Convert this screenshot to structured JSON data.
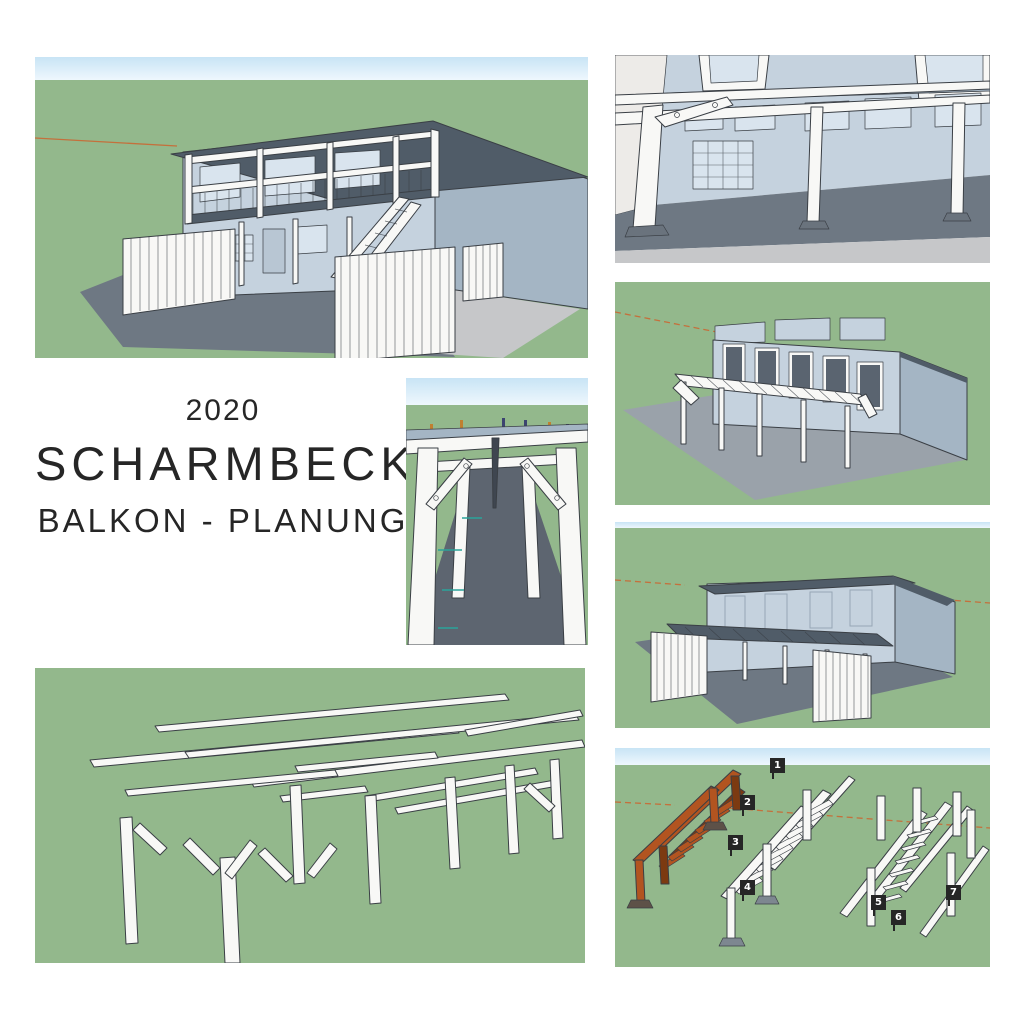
{
  "title": {
    "year": "2020",
    "name": "SCHARMBECK",
    "subtitle": "BALKON - PLANUNG"
  },
  "stair_tags": [
    "1",
    "2",
    "3",
    "4",
    "5",
    "6",
    "7"
  ],
  "colors": {
    "grass": "#93b88c",
    "sky_top": "#c8e4f5",
    "sky_bottom": "#eef7fd",
    "wall_light": "#c5d2de",
    "wall_shade": "#a4b5c4",
    "roof_dark": "#505c68",
    "floor_dark": "#5d6570",
    "shadow": "#6e7883",
    "shadow_light": "#9aa2aa",
    "ground_gray": "#c6c7c9",
    "frame_white": "#f8f8f6",
    "outline": "#3a3f45",
    "stairs_orange": "#b25420",
    "stairs_orange_dark": "#7c3a11",
    "axis_line": "#c4703c",
    "tag_bg": "#262626",
    "tag_text": "#ffffff",
    "wall_white": "#edebe8",
    "window_glass": "#d9e4ee",
    "window_dark": "#5a6470",
    "teal": "#2ba39a",
    "pin_orange": "#c08030",
    "pin_blue": "#3c4470",
    "text": "#262626"
  }
}
